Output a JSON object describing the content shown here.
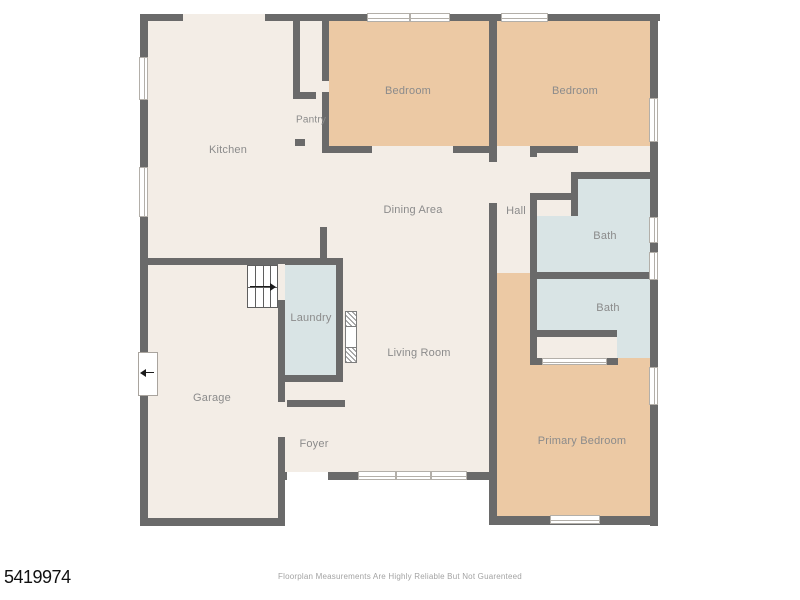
{
  "footer": {
    "disclaimer": "Floorplan Measurements Are Highly Reliable But Not Guarenteed",
    "listing_id": "5419974"
  },
  "palette": {
    "wall": "#6a6a6a",
    "cream": "#f3ede6",
    "tan": "#ecc9a4",
    "blue": "#d9e4e5",
    "white": "#ffffff",
    "label": "#8b8b8b",
    "window_border": "#b3afa9"
  },
  "floorplan": {
    "floors": [
      {
        "name": "main-living-area",
        "x": 148,
        "y": 21,
        "w": 344,
        "h": 459,
        "fill": "cream"
      },
      {
        "name": "garage-lower",
        "x": 148,
        "y": 480,
        "w": 130,
        "h": 38,
        "fill": "cream"
      },
      {
        "name": "bedroom-1",
        "x": 329,
        "y": 21,
        "w": 160,
        "h": 125,
        "fill": "tan"
      },
      {
        "name": "bedroom-2",
        "x": 497,
        "y": 21,
        "w": 156,
        "h": 125,
        "fill": "tan"
      },
      {
        "name": "closet-strip",
        "x": 497,
        "y": 146,
        "w": 156,
        "h": 33,
        "fill": "cream"
      },
      {
        "name": "hall",
        "x": 497,
        "y": 179,
        "w": 40,
        "h": 94,
        "fill": "cream"
      },
      {
        "name": "primary-suite",
        "x": 497,
        "y": 273,
        "w": 156,
        "h": 245,
        "fill": "tan"
      },
      {
        "name": "bath-1",
        "x": 537,
        "y": 179,
        "w": 116,
        "h": 94,
        "fill": "blue"
      },
      {
        "name": "bath-1-entry-notch",
        "x": 537,
        "y": 179,
        "w": 34,
        "h": 37,
        "fill": "cream"
      },
      {
        "name": "bath-2",
        "x": 537,
        "y": 279,
        "w": 116,
        "h": 81,
        "fill": "blue"
      },
      {
        "name": "primary-closet",
        "x": 537,
        "y": 337,
        "w": 80,
        "h": 23,
        "fill": "cream"
      },
      {
        "name": "laundry",
        "x": 285,
        "y": 265,
        "w": 57,
        "h": 110,
        "fill": "blue"
      }
    ],
    "walls": [
      {
        "x": 140,
        "y": 14,
        "w": 520,
        "h": 7
      },
      {
        "x": 140,
        "y": 14,
        "w": 8,
        "h": 512
      },
      {
        "x": 650,
        "y": 14,
        "w": 8,
        "h": 512
      },
      {
        "x": 140,
        "y": 518,
        "w": 145,
        "h": 8
      },
      {
        "x": 489,
        "y": 516,
        "w": 169,
        "h": 9
      },
      {
        "x": 281,
        "y": 472,
        "w": 213,
        "h": 8
      },
      {
        "x": 140,
        "y": 258,
        "w": 203,
        "h": 7
      },
      {
        "x": 278,
        "y": 258,
        "w": 7,
        "h": 6
      },
      {
        "x": 278,
        "y": 300,
        "w": 7,
        "h": 102
      },
      {
        "x": 278,
        "y": 437,
        "w": 7,
        "h": 81
      },
      {
        "x": 489,
        "y": 14,
        "w": 8,
        "h": 148
      },
      {
        "x": 489,
        "y": 203,
        "w": 8,
        "h": 315
      },
      {
        "x": 322,
        "y": 14,
        "w": 7,
        "h": 67
      },
      {
        "x": 322,
        "y": 92,
        "w": 7,
        "h": 54
      },
      {
        "x": 293,
        "y": 14,
        "w": 7,
        "h": 85
      },
      {
        "x": 293,
        "y": 92,
        "w": 23,
        "h": 7
      },
      {
        "x": 295,
        "y": 139,
        "w": 10,
        "h": 7
      },
      {
        "x": 322,
        "y": 146,
        "w": 50,
        "h": 7
      },
      {
        "x": 453,
        "y": 146,
        "w": 36,
        "h": 7
      },
      {
        "x": 533,
        "y": 146,
        "w": 45,
        "h": 7
      },
      {
        "x": 530,
        "y": 146,
        "w": 7,
        "h": 11
      },
      {
        "x": 530,
        "y": 193,
        "w": 7,
        "h": 172
      },
      {
        "x": 571,
        "y": 172,
        "w": 82,
        "h": 7
      },
      {
        "x": 571,
        "y": 172,
        "w": 7,
        "h": 44
      },
      {
        "x": 530,
        "y": 193,
        "w": 45,
        "h": 7
      },
      {
        "x": 537,
        "y": 272,
        "w": 116,
        "h": 7
      },
      {
        "x": 537,
        "y": 330,
        "w": 80,
        "h": 7
      },
      {
        "x": 533,
        "y": 358,
        "w": 9,
        "h": 7
      },
      {
        "x": 607,
        "y": 358,
        "w": 11,
        "h": 7
      },
      {
        "x": 320,
        "y": 227,
        "w": 7,
        "h": 38
      },
      {
        "x": 336,
        "y": 258,
        "w": 7,
        "h": 117
      },
      {
        "x": 278,
        "y": 375,
        "w": 65,
        "h": 7
      },
      {
        "x": 287,
        "y": 400,
        "w": 58,
        "h": 7
      }
    ],
    "openings": [
      {
        "name": "kitchen-top-opening",
        "x": 183,
        "y": 14,
        "w": 82,
        "h": 7,
        "fill": "cream"
      },
      {
        "name": "pantry-door",
        "x": 316,
        "y": 92,
        "w": 6,
        "h": 7,
        "fill": "cream"
      },
      {
        "name": "bedroom-1-door",
        "x": 322,
        "y": 81,
        "w": 7,
        "h": 11,
        "fill": "cream"
      },
      {
        "name": "dining-hall-door",
        "x": 489,
        "y": 162,
        "w": 8,
        "h": 41,
        "fill": "cream"
      },
      {
        "name": "hall-closet-door",
        "x": 530,
        "y": 157,
        "w": 7,
        "h": 36,
        "fill": "cream"
      },
      {
        "name": "stair-landing-opening",
        "x": 278,
        "y": 264,
        "w": 7,
        "h": 36,
        "fill": "cream"
      },
      {
        "name": "garage-foyer-door",
        "x": 278,
        "y": 402,
        "w": 7,
        "h": 35,
        "fill": "cream"
      },
      {
        "name": "front-entry-door",
        "x": 287,
        "y": 472,
        "w": 41,
        "h": 8,
        "fill": "white"
      },
      {
        "name": "bath-2-door",
        "x": 618,
        "y": 358,
        "w": 32,
        "h": 7,
        "fill": "tan"
      },
      {
        "name": "closet-sliding-door",
        "x": 542,
        "y": 358,
        "w": 65,
        "h": 7,
        "fill": "white",
        "slider": true
      }
    ],
    "windows": [
      {
        "x": 367,
        "y": 13,
        "w": 83,
        "h": 9,
        "o": "h",
        "panes": 2
      },
      {
        "x": 501,
        "y": 13,
        "w": 47,
        "h": 9,
        "o": "h",
        "panes": 1
      },
      {
        "x": 139,
        "y": 57,
        "w": 9,
        "h": 43,
        "o": "v",
        "panes": 1
      },
      {
        "x": 139,
        "y": 167,
        "w": 9,
        "h": 50,
        "o": "v",
        "panes": 1
      },
      {
        "x": 649,
        "y": 98,
        "w": 9,
        "h": 44,
        "o": "v",
        "panes": 1
      },
      {
        "x": 649,
        "y": 217,
        "w": 9,
        "h": 26,
        "o": "v",
        "panes": 1
      },
      {
        "x": 649,
        "y": 252,
        "w": 9,
        "h": 28,
        "o": "v",
        "panes": 1
      },
      {
        "x": 649,
        "y": 367,
        "w": 9,
        "h": 38,
        "o": "v",
        "panes": 1
      },
      {
        "x": 358,
        "y": 471,
        "w": 109,
        "h": 9,
        "o": "h",
        "panes": 3
      },
      {
        "x": 550,
        "y": 515,
        "w": 50,
        "h": 9,
        "o": "h",
        "panes": 1
      }
    ],
    "stairs": {
      "x": 247,
      "y": 265,
      "w": 31,
      "h": 43
    },
    "fireplace": {
      "x": 345,
      "y": 311,
      "w": 12,
      "h": 52
    },
    "garage_side_door": {
      "x": 138,
      "y": 352,
      "w": 20,
      "h": 44
    },
    "labels": [
      {
        "slug": "kitchen",
        "text": "Kitchen",
        "x": 228,
        "y": 150,
        "size": 11
      },
      {
        "slug": "pantry",
        "text": "Pantry",
        "x": 311,
        "y": 120,
        "size": 10
      },
      {
        "slug": "bedroom-1",
        "text": "Bedroom",
        "x": 408,
        "y": 91,
        "size": 11
      },
      {
        "slug": "bedroom-2",
        "text": "Bedroom",
        "x": 575,
        "y": 91,
        "size": 11
      },
      {
        "slug": "dining-area",
        "text": "Dining Area",
        "x": 413,
        "y": 210,
        "size": 11
      },
      {
        "slug": "hall",
        "text": "Hall",
        "x": 516,
        "y": 211,
        "size": 11
      },
      {
        "slug": "bath-1",
        "text": "Bath",
        "x": 605,
        "y": 236,
        "size": 11
      },
      {
        "slug": "bath-2",
        "text": "Bath",
        "x": 608,
        "y": 308,
        "size": 11
      },
      {
        "slug": "laundry",
        "text": "Laundry",
        "x": 311,
        "y": 318,
        "size": 11
      },
      {
        "slug": "living-room",
        "text": "Living Room",
        "x": 419,
        "y": 353,
        "size": 11
      },
      {
        "slug": "garage",
        "text": "Garage",
        "x": 212,
        "y": 398,
        "size": 11
      },
      {
        "slug": "foyer",
        "text": "Foyer",
        "x": 314,
        "y": 444,
        "size": 11
      },
      {
        "slug": "primary-bedroom",
        "text": "Primary Bedroom",
        "x": 582,
        "y": 441,
        "size": 11
      }
    ]
  }
}
